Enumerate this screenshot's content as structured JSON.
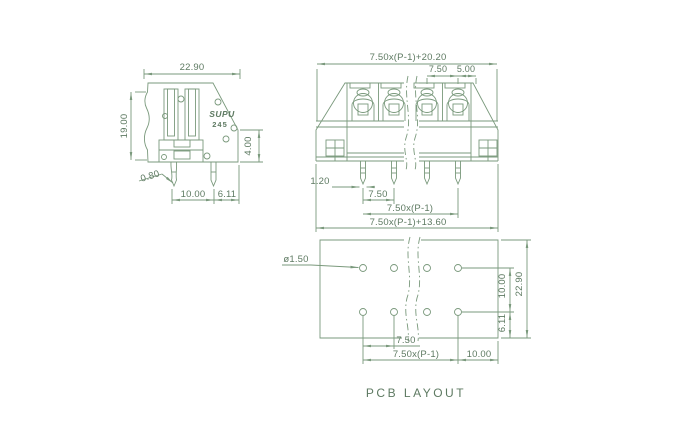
{
  "colors": {
    "line": "#7a997c",
    "text": "#5e7a62",
    "background": "#ffffff"
  },
  "caption": "PCB LAYOUT",
  "side_view": {
    "logo": "SUPU",
    "model": "245",
    "dim_width": "22.90",
    "dim_height": "19.00",
    "dim_pin_length": "4.00",
    "dim_pin_thickness": "0.80",
    "dim_pin_pitch": "10.00",
    "dim_pin_to_edge": "6.11"
  },
  "front_view": {
    "dim_overall_width": "7.50x(P-1)+20.20",
    "dim_pitch": "7.50",
    "dim_terminal_width": "5.00",
    "dim_pin_width": "1.20",
    "dim_pin_pitch": "7.50",
    "dim_pin_span": "7.50x(P-1)",
    "dim_body_width": "7.50x(P-1)+13.60"
  },
  "pcb_layout": {
    "dim_hole_diameter": "ø1.50",
    "dim_row_spacing": "10.00",
    "dim_board_height": "22.90",
    "dim_row_to_edge": "6.11",
    "dim_hole_pitch": "7.50",
    "dim_hole_span": "7.50x(P-1)",
    "dim_span_to_edge": "10.00"
  }
}
